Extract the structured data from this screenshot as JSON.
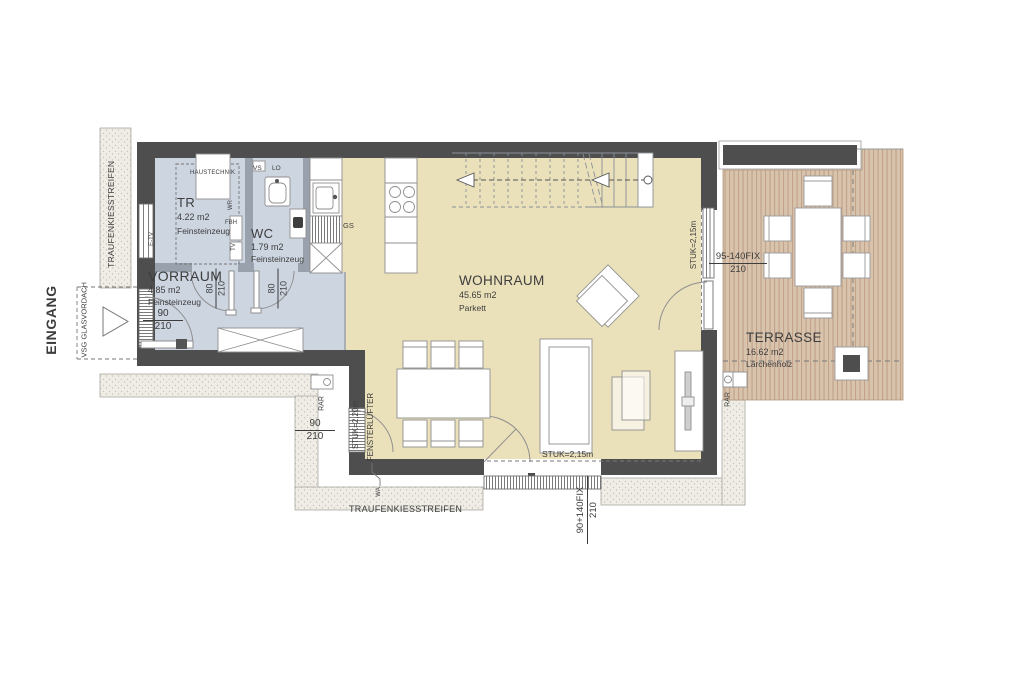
{
  "colors": {
    "wall": "#4e4e4e",
    "partition": "#99a1ac",
    "floor_tile": "#cdd5e1",
    "floor_parquet": "#eae0ba",
    "deck_base": "#d8c3ad",
    "deck_stripe": "#c2a289",
    "gravel_base": "#efede6",
    "gravel_dot": "#c6c3b8",
    "line": "#8a8a8a",
    "text": "#3d3d3d"
  },
  "rooms": {
    "tr": {
      "name": "TR",
      "area": "4.22 m2",
      "floor": "Feinsteinzeug"
    },
    "wc": {
      "name": "WC",
      "area": "1.79 m2",
      "floor": "Feinsteinzeug"
    },
    "vorraum": {
      "name": "VORRAUM",
      "area": "4.85 m2",
      "floor": "Feinsteinzeug"
    },
    "wohnraum": {
      "name": "WOHNRAUM",
      "area": "45.65 m2",
      "floor": "Parkett"
    },
    "terrasse": {
      "name": "TERRASSE",
      "area": "16.62 m2",
      "floor": "Lärchenholz"
    }
  },
  "site": {
    "eingang": "EINGANG",
    "canopy": "VSG GLASVORDACH",
    "gravel_left": "TRAUFENKIESSTREIFEN",
    "gravel_bottom": "TRAUFENKIESSTREIFEN"
  },
  "equipment": {
    "haustechnik": "HAUSTECHNIK",
    "vs": "VS",
    "lo": "LO",
    "gs": "GS",
    "rar_left": "RAR",
    "rar_right": "RAR",
    "wa": "WA",
    "e_tv": "E-TV",
    "wr": "WR",
    "fbh": "FBH",
    "tv": "TV",
    "fensterluefter": "FENSTERLÜFTER"
  },
  "dimensions": {
    "entry_door": {
      "width": "90",
      "height": "210"
    },
    "tr_door": {
      "width": "80",
      "height": "210"
    },
    "wc_door": {
      "width": "80",
      "height": "210"
    },
    "west_window": {
      "width": "90",
      "height": "210"
    },
    "south_window": {
      "width": "90+140FIX",
      "height": "210"
    },
    "east_window": {
      "width": "95-140FIX",
      "height": "210"
    },
    "ceiling_east": "STUK=2,15m",
    "ceiling_south": "STUK=2,15m",
    "ceiling_west": "STUK=2,20m"
  }
}
